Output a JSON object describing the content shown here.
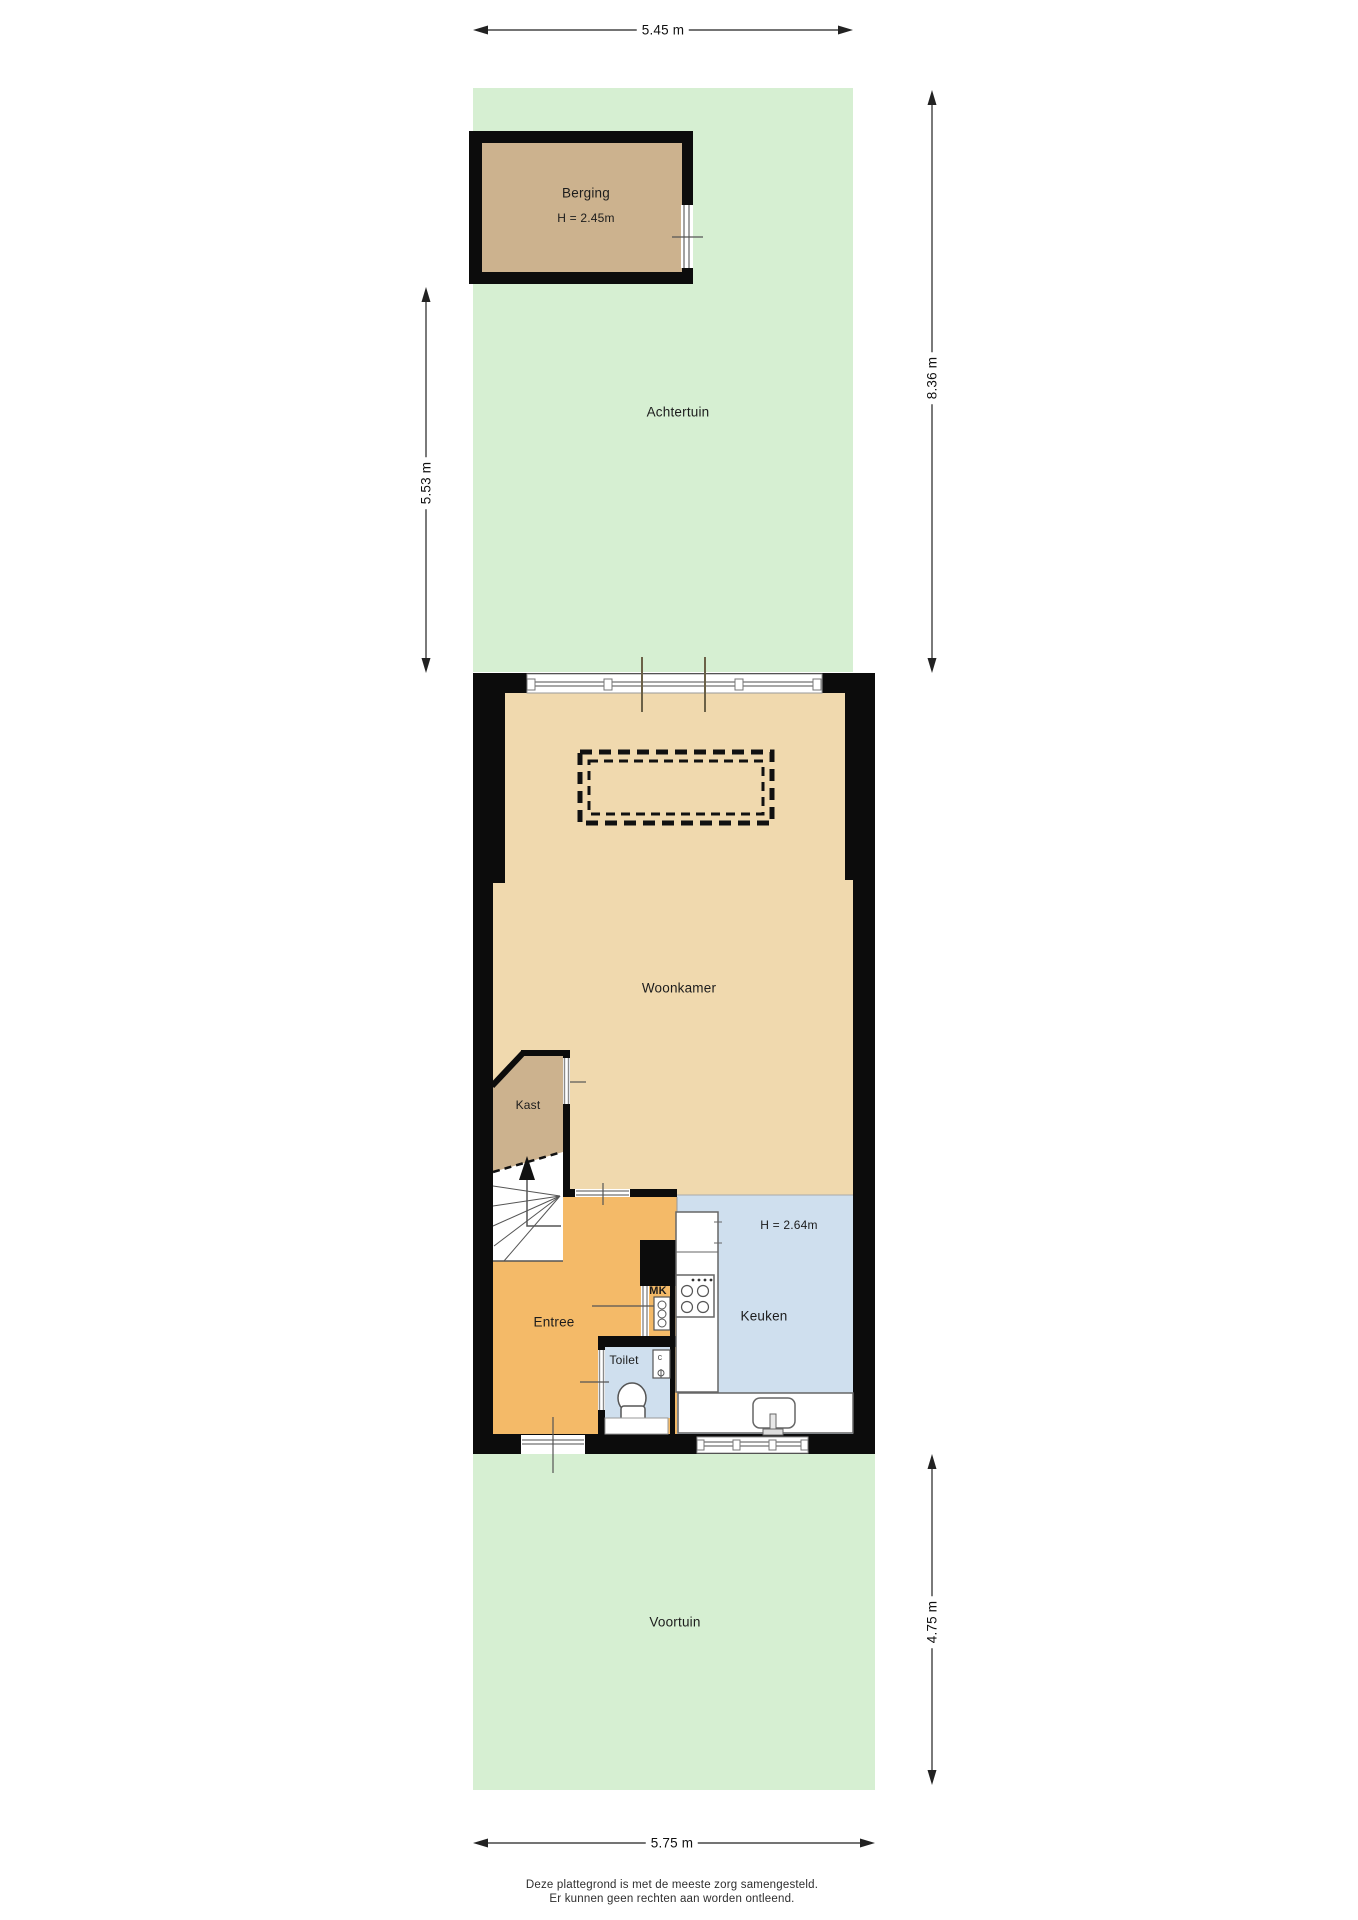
{
  "rooms": {
    "berging": {
      "label": "Berging",
      "height_label": "H = 2.45m"
    },
    "achtertuin": {
      "label": "Achtertuin"
    },
    "woonkamer": {
      "label": "Woonkamer"
    },
    "kast": {
      "label": "Kast"
    },
    "entree": {
      "label": "Entree"
    },
    "meterkast": {
      "label": "MK"
    },
    "toilet": {
      "label": "Toilet"
    },
    "keuken": {
      "label": "Keuken",
      "height_label": "H = 2.64m"
    },
    "voortuin": {
      "label": "Voortuin"
    },
    "boiler": {
      "label": "c"
    }
  },
  "dimensions": {
    "top": {
      "label": "5.45 m"
    },
    "left": {
      "label": "5.53 m"
    },
    "right_upper": {
      "label": "8.36 m"
    },
    "right_lower": {
      "label": "4.75 m"
    },
    "bottom": {
      "label": "5.75 m"
    }
  },
  "footer": {
    "line1": "Deze plattegrond is met de meeste zorg samengesteld.",
    "line2": "Er kunnen geen rechten aan worden ontleend."
  },
  "colors": {
    "garden-green": "#d6efd2",
    "floor-tan": "#f0d9ae",
    "storage-tan": "#ccb28e",
    "entry-orange": "#f4ba68",
    "kitchen-blue": "#cfdfee",
    "wall-black": "#0c0c0c",
    "fixture-line": "#666666",
    "dim-line": "#222222",
    "text-dark": "#1c1c1c"
  }
}
